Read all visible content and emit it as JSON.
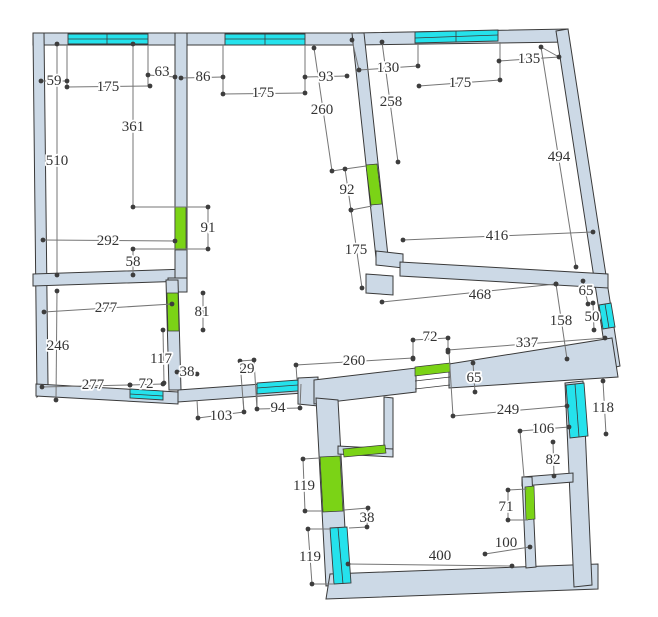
{
  "app": {
    "name": "floor-plan-drawing"
  },
  "canvas": {
    "width": 658,
    "height": 617,
    "background": "#ffffff"
  },
  "colors": {
    "wall_fill": "#ccd9e6",
    "wall_outline": "#3a3a3a",
    "window_fill": "#25e2ec",
    "door_fill": "#7bd316",
    "dim_line": "#757575",
    "dim_dot": "#3d3d3d",
    "dim_text": "#333333"
  },
  "plan": {
    "walls": [
      {
        "name": "top-wall-left",
        "points": "33,33 355,33 355,45 33,45"
      },
      {
        "name": "top-wall-right",
        "points": "355,33 568,29 568,42 355,45"
      },
      {
        "name": "right-outer-wall",
        "points": "556,31 568,29 620,366 608,369"
      },
      {
        "name": "left-outer-wall",
        "points": "33,33 44,33 48,385 37,397"
      },
      {
        "name": "topleft-room-bottom-wall",
        "points": "33,274 187,269 187,281 33,286"
      },
      {
        "name": "divider-wall-vertical",
        "points": "175,33 187,33 187,281 175,281"
      },
      {
        "name": "divider-junction-block",
        "points": "168,278 187,278 187,292 168,292"
      },
      {
        "name": "bottomleft-room-right-wall",
        "points": "166,280 178,280 181,390 169,390"
      },
      {
        "name": "south-wall-bottomleft",
        "points": "36,384 178,392 178,404 36,396"
      },
      {
        "name": "south-wall-center",
        "points": "178,390 303,381 303,393 178,402"
      },
      {
        "name": "south-corner-block",
        "points": "298,378 318,377 318,406 298,404"
      },
      {
        "name": "hall-south-wall-left",
        "points": "314,380 416,368 416,392 314,404"
      },
      {
        "name": "hall-south-wall-right",
        "points": "449,364 612,338 618,377 449,388"
      },
      {
        "name": "topright-room-left-wall",
        "points": "352,33 364,33 388,256 376,258"
      },
      {
        "name": "topright-wall-step",
        "points": "376,251 403,254 403,268 376,265"
      },
      {
        "name": "topright-room-bottom-wall",
        "points": "400,262 608,274 608,288 400,276"
      },
      {
        "name": "topright-wall-foot",
        "points": "366,274 393,276 393,295 366,293"
      },
      {
        "name": "bottomroom-left-wall",
        "points": "316,398 338,400 348,584 326,586"
      },
      {
        "name": "bottomroom-bottom-wall",
        "points": "330,574 598,564 598,589 326,599"
      },
      {
        "name": "bottomroom-right-wall",
        "points": "565,383 583,381 592,585 574,587"
      },
      {
        "name": "closet-right-wall",
        "points": "384,397 393,398 393,453 384,452"
      },
      {
        "name": "closet-bottom-wall",
        "points": "338,446 393,449 393,457 338,454"
      },
      {
        "name": "innerroom-top-wall",
        "points": "522,477 573,473 573,482 522,486"
      },
      {
        "name": "innerroom-left-wall",
        "points": "522,477 532,477 536,567 526,568"
      }
    ],
    "windows": [
      {
        "name": "window-topleft-1",
        "points": "68,34 148,34 148,44 68,44",
        "midline": [
          68,
          39,
          148,
          39
        ],
        "divider": [
          107,
          34,
          107,
          44
        ]
      },
      {
        "name": "window-topleft-2",
        "points": "225,34 305,34 305,45 225,45",
        "midline": [
          225,
          39,
          305,
          39
        ],
        "divider": [
          265,
          34,
          265,
          45
        ]
      },
      {
        "name": "window-topright",
        "points": "415,32 498,30 498,41 415,43",
        "midline": [
          415,
          38,
          498,
          35
        ],
        "divider": [
          456,
          31,
          456,
          42
        ]
      },
      {
        "name": "window-right-50",
        "points": "599,305 611,303 615,327 603,329",
        "midline": [
          605,
          304,
          609,
          328
        ],
        "divider": null
      },
      {
        "name": "window-bottomleft-72",
        "points": "130,389 163,391 163,400 130,398",
        "midline": [
          130,
          394,
          163,
          396
        ],
        "divider": null
      },
      {
        "name": "window-south-94",
        "points": "257,383 298,380 298,391 257,394",
        "midline": [
          257,
          388,
          298,
          385
        ],
        "divider": null
      },
      {
        "name": "window-bottomroom-right-118",
        "points": "566,385 584,383 588,436 570,438",
        "midline": [
          575,
          384,
          579,
          437
        ],
        "divider": null
      },
      {
        "name": "window-bottomroom-left-119",
        "points": "330,528 347,527 351,583 334,584",
        "midline": [
          338,
          528,
          343,
          584
        ],
        "divider": null
      }
    ],
    "doors": [
      {
        "name": "door-91",
        "points": "175,207 186,207 186,250 175,250"
      },
      {
        "name": "door-81",
        "points": "167,293 178,293 179,331 168,331"
      },
      {
        "name": "door-92",
        "points": "366,165 377,164 382,204 371,205"
      },
      {
        "name": "door-119",
        "points": "320,457 340,456 343,511 323,512"
      },
      {
        "name": "door-closet",
        "points": "343,449 385,445 386,453 344,457"
      },
      {
        "name": "door-71",
        "points": "525,487 534,486 535,519 526,520"
      },
      {
        "name": "door-65-leaf",
        "points": "415,367 450,363 450,372 415,376"
      }
    ],
    "thresholds": [
      [
        415,
        381,
        450,
        377
      ],
      [
        415,
        389,
        450,
        385
      ]
    ],
    "connectors": [
      [
        67,
        45,
        67,
        87
      ],
      [
        148,
        45,
        148,
        86
      ],
      [
        223,
        45,
        223,
        94
      ],
      [
        305,
        45,
        305,
        94
      ],
      [
        418,
        44,
        418,
        66
      ],
      [
        500,
        42,
        500,
        80
      ],
      [
        133,
        207,
        208,
        207
      ],
      [
        133,
        249,
        208,
        249
      ],
      [
        332,
        171,
        345,
        169
      ],
      [
        345,
        169,
        366,
        166
      ],
      [
        351,
        210,
        372,
        206
      ],
      [
        413,
        340,
        413,
        359
      ],
      [
        448,
        338,
        448,
        352
      ],
      [
        449,
        352,
        453,
        416
      ],
      [
        240,
        361,
        244,
        413
      ],
      [
        254,
        360,
        257,
        410
      ],
      [
        541,
        47,
        559,
        57
      ],
      [
        352,
        40,
        359,
        70
      ],
      [
        520,
        431,
        524,
        477
      ],
      [
        303,
        459,
        320,
        458
      ],
      [
        305,
        511,
        322,
        511
      ],
      [
        368,
        508,
        344,
        510
      ],
      [
        367,
        527,
        349,
        528
      ],
      [
        308,
        529,
        331,
        529
      ],
      [
        312,
        584,
        334,
        584
      ],
      [
        508,
        490,
        527,
        489
      ],
      [
        508,
        520,
        528,
        520
      ],
      [
        198,
        418,
        197,
        400
      ],
      [
        244,
        412,
        243,
        397
      ],
      [
        257,
        409,
        257,
        394
      ],
      [
        300,
        408,
        301,
        384
      ],
      [
        296,
        365,
        297,
        380
      ]
    ],
    "dimensions": [
      {
        "label": "59",
        "line": [
          41,
          81,
          67,
          81
        ],
        "lx": 54,
        "ly": 81
      },
      {
        "label": "175",
        "line": [
          67,
          87,
          150,
          86
        ],
        "lx": 108,
        "ly": 87
      },
      {
        "label": "63",
        "line": [
          148,
          75,
          175,
          77
        ],
        "lx": 162,
        "ly": 72
      },
      {
        "label": "86",
        "line": [
          181,
          78,
          223,
          77
        ],
        "lx": 203,
        "ly": 77
      },
      {
        "label": "361",
        "line": [
          133,
          44,
          133,
          207
        ],
        "lx": 133,
        "ly": 127
      },
      {
        "label": "510",
        "line": [
          57,
          44,
          57,
          275
        ],
        "lx": 57,
        "ly": 161
      },
      {
        "label": "292",
        "line": [
          43,
          240,
          175,
          241
        ],
        "lx": 108,
        "ly": 241
      },
      {
        "label": "91",
        "line": [
          208,
          207,
          208,
          249
        ],
        "lx": 208,
        "ly": 228
      },
      {
        "label": "58",
        "line": [
          133,
          249,
          133,
          275
        ],
        "lx": 133,
        "ly": 262
      },
      {
        "label": "175",
        "line": [
          223,
          94,
          305,
          93
        ],
        "lx": 263,
        "ly": 93
      },
      {
        "label": "93",
        "line": [
          305,
          77,
          347,
          76
        ],
        "lx": 326,
        "ly": 77
      },
      {
        "label": "260",
        "line": [
          314,
          48,
          332,
          171
        ],
        "lx": 322,
        "ly": 110
      },
      {
        "label": "92",
        "line": [
          345,
          169,
          351,
          210
        ],
        "lx": 347,
        "ly": 190
      },
      {
        "label": "175",
        "line": [
          351,
          210,
          362,
          288
        ],
        "lx": 356,
        "ly": 250
      },
      {
        "label": "130",
        "line": [
          359,
          70,
          418,
          66
        ],
        "lx": 388,
        "ly": 68
      },
      {
        "label": "175",
        "line": [
          419,
          86,
          500,
          80
        ],
        "lx": 460,
        "ly": 83
      },
      {
        "label": "135",
        "line": [
          499,
          61,
          559,
          57
        ],
        "lx": 529,
        "ly": 59
      },
      {
        "label": "258",
        "line": [
          382,
          42,
          398,
          162
        ],
        "lx": 391,
        "ly": 102
      },
      {
        "label": "494",
        "line": [
          541,
          47,
          576,
          267
        ],
        "lx": 559,
        "ly": 157
      },
      {
        "label": "416",
        "line": [
          403,
          240,
          593,
          232
        ],
        "lx": 497,
        "ly": 236
      },
      {
        "label": "468",
        "line": [
          382,
          302,
          556,
          284
        ],
        "lx": 480,
        "ly": 295
      },
      {
        "label": "65",
        "line": [
          583,
          281,
          588,
          304
        ],
        "lx": 586,
        "ly": 291
      },
      {
        "label": "158",
        "line": [
          556,
          284,
          567,
          359
        ],
        "lx": 561,
        "ly": 321
      },
      {
        "label": "50",
        "line": [
          593,
          303,
          594,
          330
        ],
        "lx": 592,
        "ly": 317
      },
      {
        "label": "72",
        "line": [
          413,
          340,
          448,
          338
        ],
        "lx": 430,
        "ly": 337
      },
      {
        "label": "337",
        "line": [
          448,
          350,
          605,
          338
        ],
        "lx": 527,
        "ly": 343
      },
      {
        "label": "260",
        "line": [
          296,
          365,
          413,
          358
        ],
        "lx": 354,
        "ly": 361
      },
      {
        "label": "65",
        "line": [
          473,
          363,
          475,
          392
        ],
        "lx": 474,
        "ly": 378
      },
      {
        "label": "249",
        "line": [
          453,
          416,
          567,
          406
        ],
        "lx": 508,
        "ly": 410
      },
      {
        "label": "103",
        "line": [
          198,
          418,
          244,
          412
        ],
        "lx": 221,
        "ly": 416
      },
      {
        "label": "94",
        "line": [
          257,
          409,
          300,
          408
        ],
        "lx": 278,
        "ly": 408
      },
      {
        "label": "29",
        "line": [
          240,
          361,
          254,
          360
        ],
        "lx": 247,
        "ly": 369
      },
      {
        "label": "38",
        "line": [
          177,
          372,
          197,
          374
        ],
        "lx": 187,
        "ly": 372
      },
      {
        "label": "117",
        "line": [
          163,
          330,
          164,
          383
        ],
        "lx": 161,
        "ly": 359
      },
      {
        "label": "72",
        "line": [
          130,
          385,
          163,
          384
        ],
        "lx": 146,
        "ly": 384
      },
      {
        "label": "277",
        "line": [
          42,
          387,
          130,
          385
        ],
        "lx": 93,
        "ly": 385
      },
      {
        "label": "277",
        "line": [
          44,
          312,
          172,
          304
        ],
        "lx": 106,
        "ly": 308
      },
      {
        "label": "246",
        "line": [
          57,
          291,
          56,
          400
        ],
        "lx": 58,
        "ly": 346
      },
      {
        "label": "81",
        "line": [
          203,
          293,
          203,
          330
        ],
        "lx": 202,
        "ly": 312
      },
      {
        "label": "119",
        "line": [
          303,
          459,
          305,
          511
        ],
        "lx": 304,
        "ly": 486
      },
      {
        "label": "38",
        "line": [
          368,
          508,
          367,
          527
        ],
        "lx": 367,
        "ly": 518
      },
      {
        "label": "119",
        "line": [
          308,
          529,
          312,
          584
        ],
        "lx": 310,
        "ly": 557
      },
      {
        "label": "400",
        "line": [
          348,
          564,
          512,
          566
        ],
        "lx": 440,
        "ly": 556
      },
      {
        "label": "100",
        "line": [
          485,
          554,
          530,
          547
        ],
        "lx": 506,
        "ly": 543
      },
      {
        "label": "71",
        "line": [
          508,
          490,
          508,
          520
        ],
        "lx": 506,
        "ly": 507
      },
      {
        "label": "82",
        "line": [
          553,
          442,
          554,
          476
        ],
        "lx": 553,
        "ly": 460
      },
      {
        "label": "106",
        "line": [
          520,
          431,
          569,
          427
        ],
        "lx": 543,
        "ly": 429
      },
      {
        "label": "118",
        "line": [
          603,
          381,
          606,
          434
        ],
        "lx": 603,
        "ly": 408
      }
    ],
    "extra_dots": [
      [
        352,
        40
      ],
      [
        413,
        359
      ],
      [
        448,
        352
      ]
    ]
  }
}
